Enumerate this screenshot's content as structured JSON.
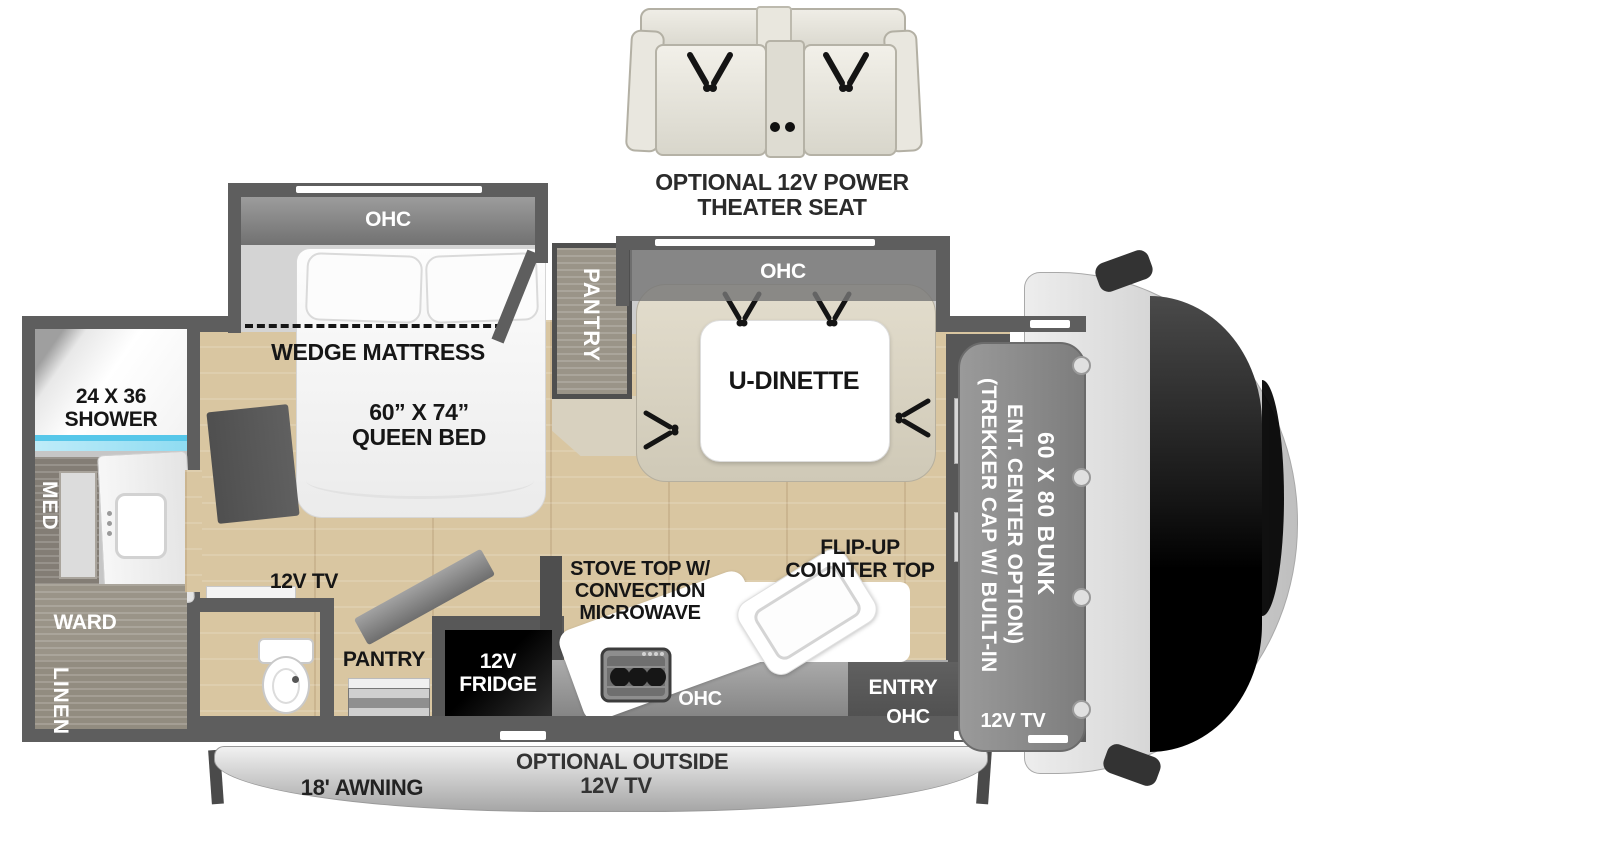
{
  "theater_seat": {
    "line1": "OPTIONAL 12V POWER",
    "line2": "THEATER SEAT"
  },
  "bedroom": {
    "ohc": "OHC",
    "wedge": "WEDGE MATTRESS",
    "size": "60” X 74”",
    "name": "QUEEN BED",
    "tv": "12V TV"
  },
  "bathroom": {
    "shower1": "24 X 36",
    "shower2": "SHOWER",
    "med": "MED",
    "ward": "WARD",
    "linen": "LINEN"
  },
  "dinette": {
    "pantry": "PANTRY",
    "ohc": "OHC",
    "label": "U-DINETTE"
  },
  "kitchen": {
    "stove1": "STOVE TOP W/",
    "stove2": "CONVECTION",
    "stove3": "MICROWAVE",
    "flip1": "FLIP-UP",
    "flip2": "COUNTER TOP",
    "fridge1": "12V",
    "fridge2": "FRIDGE",
    "pantry": "PANTRY",
    "ohc": "OHC"
  },
  "entry": {
    "label": "ENTRY",
    "ohc": "OHC",
    "tv": "12V TV"
  },
  "front_cap": {
    "trekker1": "(TREKKER CAP W/ BUILT-IN",
    "trekker2": "ENT. CENTER OPTION)",
    "bunk": "60 X 80 BUNK"
  },
  "exterior": {
    "awning": "18' AWNING",
    "outside1": "OPTIONAL OUTSIDE",
    "outside2": "12V TV"
  },
  "colors": {
    "wood": "#d9c6a1",
    "wall": "#5e5e5e",
    "ohc-band": "#8d8d8d",
    "bench": "#d9d3c2",
    "water-blue": "#57c7e9",
    "fridge": "#0b0b0b",
    "cab": "#d8d8d8",
    "bunk": "#8f8f8f",
    "bath-floor": "#c6c6c6",
    "cabinet-wood": "#9a9488",
    "awning": "#d6d6d6",
    "label-dark": "#161616"
  }
}
